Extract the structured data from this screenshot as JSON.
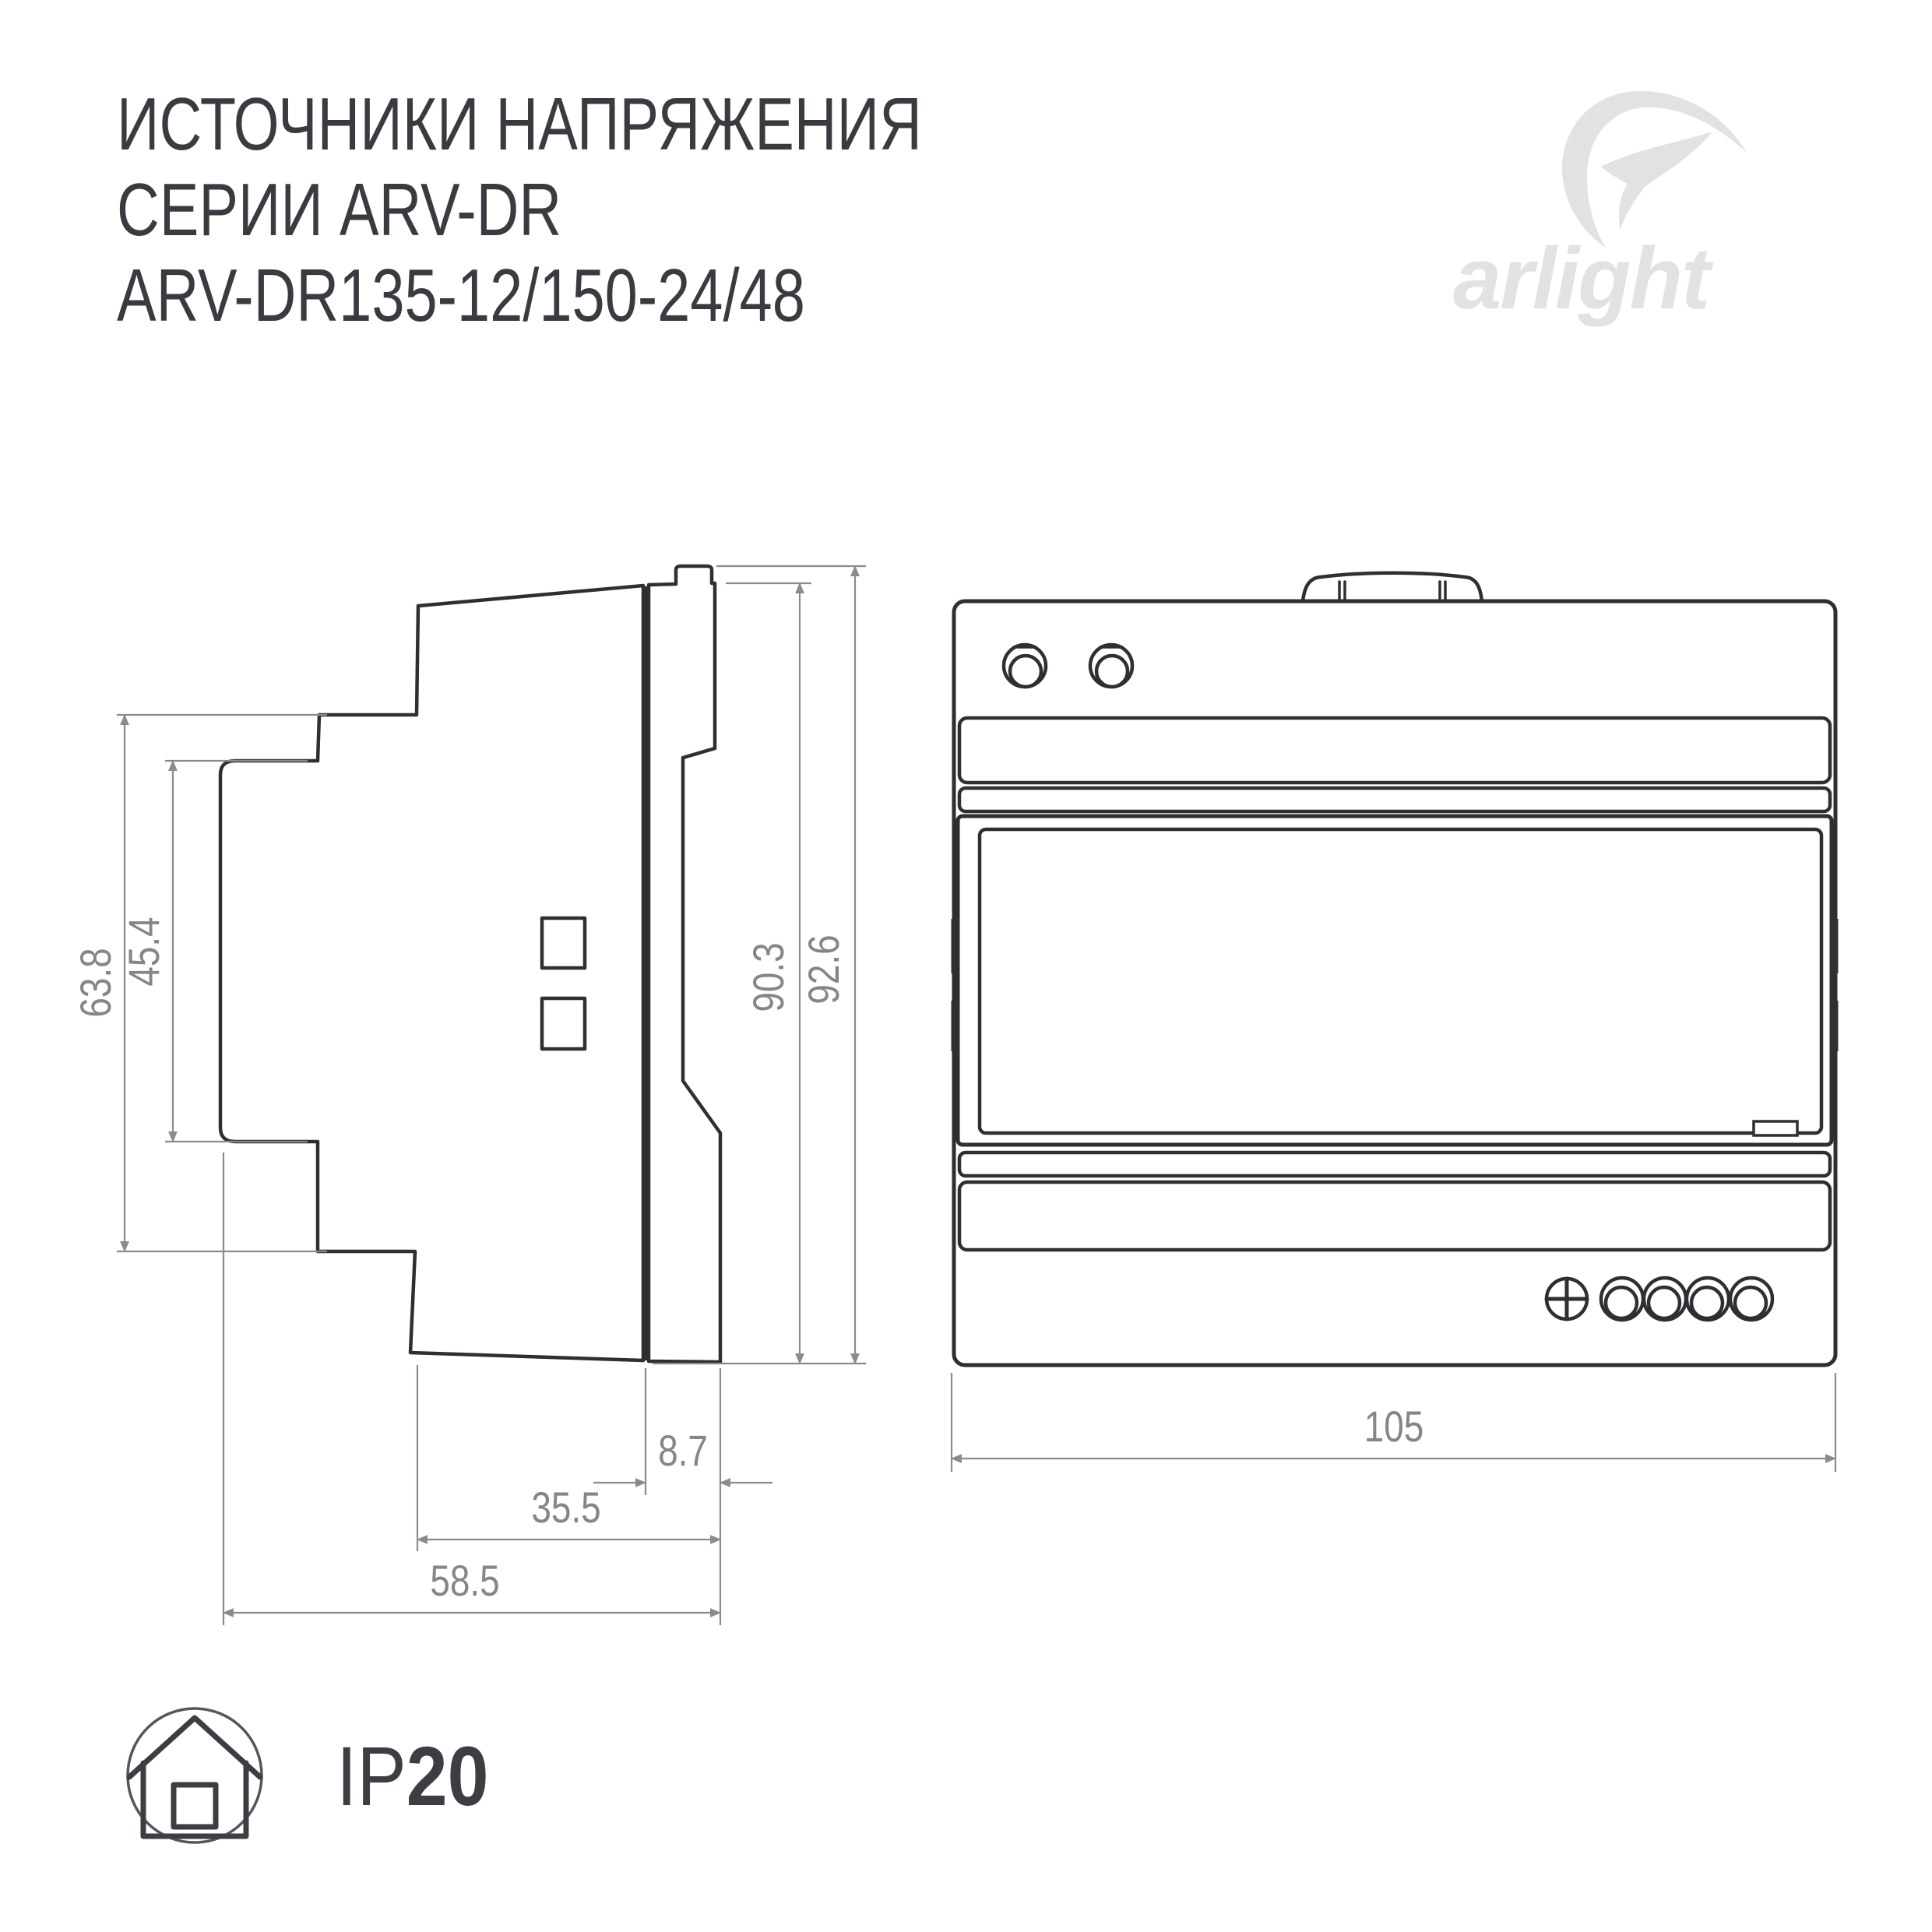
{
  "header": {
    "title_line1": "ИСТОЧНИКИ НАПРЯЖЕНИЯ",
    "title_line2": "СЕРИИ ARV-DR",
    "title_line3": "ARV-DR135-12/150-24/48"
  },
  "logo": {
    "wordmark": "arlight"
  },
  "side_view": {
    "dims": {
      "outer_height": "63.8",
      "inner_height": "45.4",
      "body_height": "90.3",
      "total_height": "92.6",
      "rail_depth": "8.7",
      "mid_depth": "35.5",
      "total_depth": "58.5"
    }
  },
  "front_view": {
    "dims": {
      "width": "105"
    }
  },
  "badge": {
    "prefix": "IP",
    "rating": "20"
  },
  "colors": {
    "drawing_line": "#2e2e33",
    "dimension_gray": "#8a8a8f",
    "title_text": "#3a3a41",
    "logo_gray": "#e2e2e4",
    "badge_dark": "#3d3d44"
  }
}
